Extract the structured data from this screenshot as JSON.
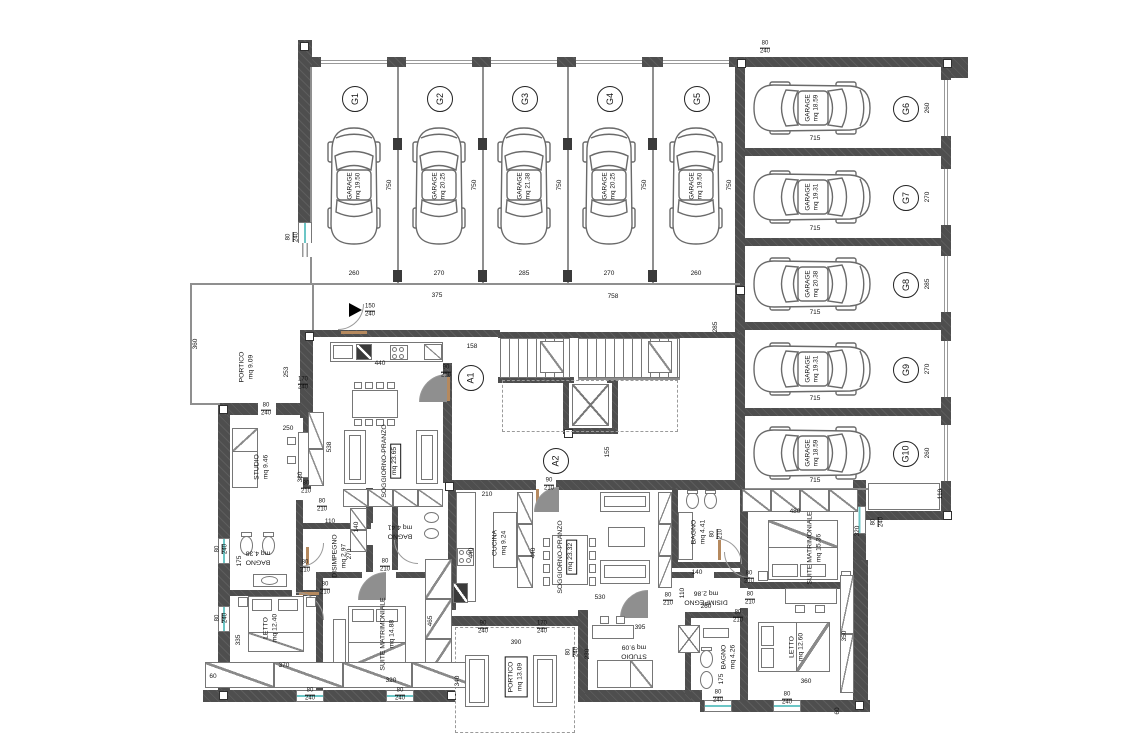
{
  "garages_top": [
    {
      "id": "G1",
      "label": "GARAGE",
      "area": "mq 19.50",
      "width": "260",
      "depth": "750",
      "door_w": "260",
      "door_h": "240"
    },
    {
      "id": "G2",
      "label": "GARAGE",
      "area": "mq 20.25",
      "width": "270",
      "depth": "750",
      "door_w": "260",
      "door_h": "240"
    },
    {
      "id": "G3",
      "label": "GARAGE",
      "area": "mq 21.38",
      "width": "285",
      "depth": "750",
      "door_w": "260",
      "door_h": "240"
    },
    {
      "id": "G4",
      "label": "GARAGE",
      "area": "mq 20.25",
      "width": "270",
      "depth": "750",
      "door_w": "260",
      "door_h": "240"
    },
    {
      "id": "G5",
      "label": "GARAGE",
      "area": "mq 19.50",
      "width": "260",
      "depth": "750",
      "door_w": "260",
      "door_h": "240"
    }
  ],
  "garages_right": [
    {
      "id": "G6",
      "label": "GARAGE",
      "area": "mq 18.59",
      "width": "260",
      "depth": "715",
      "door_w": "260",
      "door_h": "240"
    },
    {
      "id": "G7",
      "label": "GARAGE",
      "area": "mq 19.31",
      "width": "270",
      "depth": "715",
      "door_w": "260",
      "door_h": "240"
    },
    {
      "id": "G8",
      "label": "GARAGE",
      "area": "mq 20.38",
      "width": "285",
      "depth": "715",
      "door_w": "260",
      "door_h": "240"
    },
    {
      "id": "G9",
      "label": "GARAGE",
      "area": "mq 19.31",
      "width": "270",
      "depth": "715",
      "door_w": "260",
      "door_h": "240"
    },
    {
      "id": "G10",
      "label": "GARAGE",
      "area": "mq 18.59",
      "width": "260",
      "depth": "715",
      "door_w": "260",
      "door_h": "240"
    }
  ],
  "apartment_labels": [
    "A1",
    "A2"
  ],
  "rooms": [
    {
      "name": "PORTICO",
      "area": "mq 9.09"
    },
    {
      "name": "STUDIO",
      "area": "mq 9.46"
    },
    {
      "name": "SOGGIORNO-PRANZO",
      "area": "mq 23.65"
    },
    {
      "name": "BAGNO",
      "area": "mq 4.38"
    },
    {
      "name": "DISIMPEGNO",
      "area": "mq 2.97"
    },
    {
      "name": "BAGNO",
      "area": "mq 4.41"
    },
    {
      "name": "LETTO",
      "area": "mq 12.40"
    },
    {
      "name": "SUITE MATRIMONIALE",
      "area": "mq 14.88"
    },
    {
      "name": "CUCINA",
      "area": "mq 9.24"
    },
    {
      "name": "SOGGIORNO-PRANZO",
      "area": "mq 23.32"
    },
    {
      "name": "BAGNO",
      "area": "mq 4.41"
    },
    {
      "name": "DISIMPEGNO",
      "area": "mq 2.86"
    },
    {
      "name": "SUITE MATRIMONIALE",
      "area": "mq 15.36"
    },
    {
      "name": "LETTO",
      "area": "mq 12.60"
    },
    {
      "name": "BAGNO",
      "area": "mq 4.26"
    },
    {
      "name": "STUDIO",
      "area": "mq 9.09"
    },
    {
      "name": "PORTICO",
      "area": "mq 13.09"
    }
  ],
  "dims": [
    "110",
    "360",
    "375",
    "758",
    "285",
    "158",
    "155",
    "253",
    "440",
    "538",
    "250",
    "380",
    "110",
    "140",
    "270",
    "175",
    "335",
    "370",
    "320",
    "465",
    "60",
    "210",
    "440",
    "440",
    "530",
    "230",
    "395",
    "390",
    "340",
    "140",
    "260",
    "110",
    "480",
    "320",
    "350",
    "360",
    "175",
    "60"
  ],
  "fractions": [
    {
      "n": "80",
      "d": "240"
    },
    {
      "n": "80",
      "d": "240"
    },
    {
      "n": "150",
      "d": "240"
    },
    {
      "n": "90",
      "d": "210"
    },
    {
      "n": "90",
      "d": "210"
    },
    {
      "n": "170",
      "d": "240"
    },
    {
      "n": "80",
      "d": "240"
    },
    {
      "n": "80",
      "d": "210"
    },
    {
      "n": "80",
      "d": "210"
    },
    {
      "n": "80",
      "d": "210"
    },
    {
      "n": "80",
      "d": "210"
    },
    {
      "n": "80",
      "d": "210"
    },
    {
      "n": "80",
      "d": "240"
    },
    {
      "n": "80",
      "d": "240"
    },
    {
      "n": "80",
      "d": "240"
    },
    {
      "n": "80",
      "d": "240"
    },
    {
      "n": "90",
      "d": "240"
    },
    {
      "n": "170",
      "d": "240"
    },
    {
      "n": "80",
      "d": "240"
    },
    {
      "n": "80",
      "d": "210"
    },
    {
      "n": "80",
      "d": "210"
    },
    {
      "n": "80",
      "d": "210"
    },
    {
      "n": "80",
      "d": "210"
    },
    {
      "n": "80",
      "d": "210"
    },
    {
      "n": "80",
      "d": "240"
    },
    {
      "n": "80",
      "d": "240"
    },
    {
      "n": "80",
      "d": "240"
    }
  ]
}
